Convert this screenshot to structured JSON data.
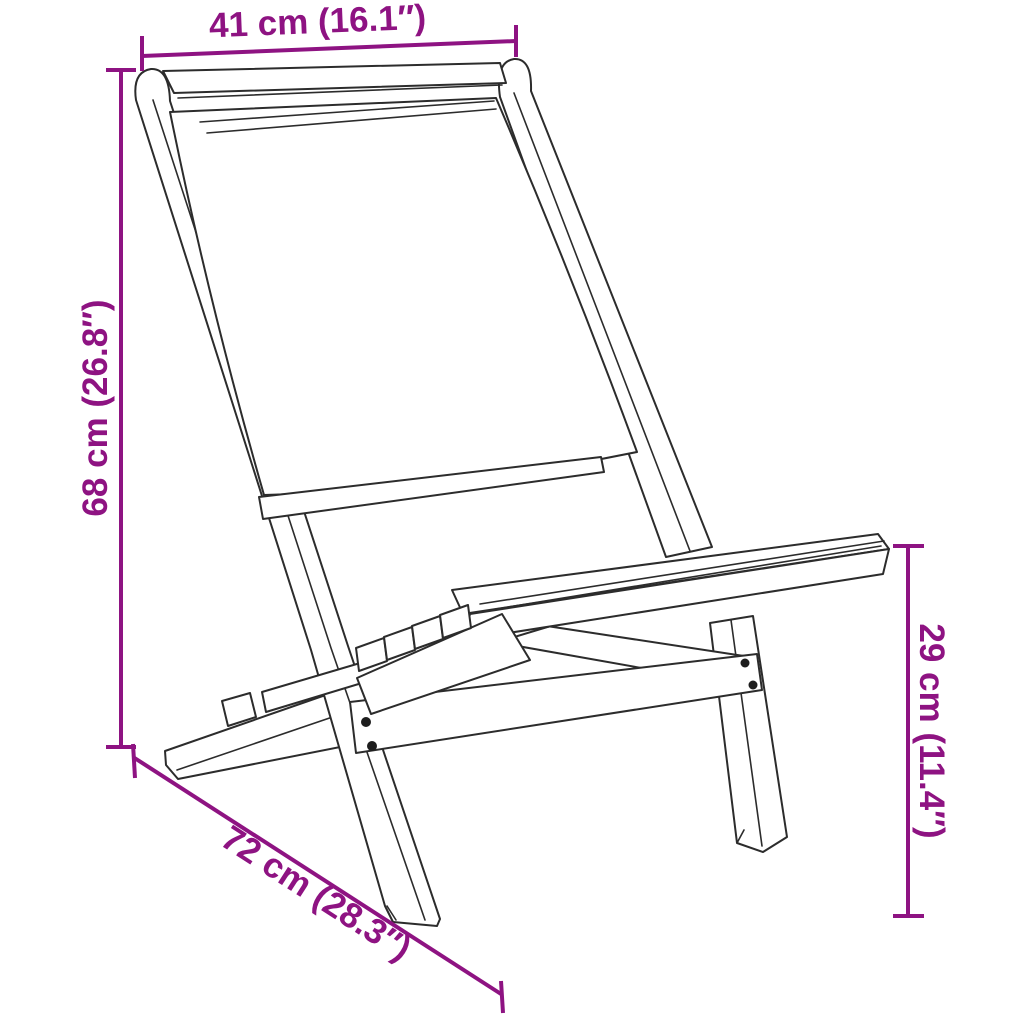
{
  "diagram": {
    "kind": "product-dimension-diagram",
    "subject": "folding chair line drawing",
    "background_color": "#ffffff",
    "drawing_color": "#2c2c2c",
    "dimension_color": "#8E1382"
  },
  "dims": {
    "width": {
      "label": "41 cm (16.1″)",
      "cm": "41 cm",
      "inches": "16.1″",
      "position": "top-horizontal"
    },
    "height": {
      "label": "68 cm (26.8″)",
      "cm": "68 cm",
      "inches": "26.8″",
      "position": "left-vertical"
    },
    "depth": {
      "label": "72 cm (28.3″)",
      "cm": "72 cm",
      "inches": "28.3″",
      "position": "bottom-diagonal"
    },
    "seat_height": {
      "label": "29 cm (11.4″)",
      "cm": "29 cm",
      "inches": "11.4″",
      "position": "right-vertical"
    }
  }
}
